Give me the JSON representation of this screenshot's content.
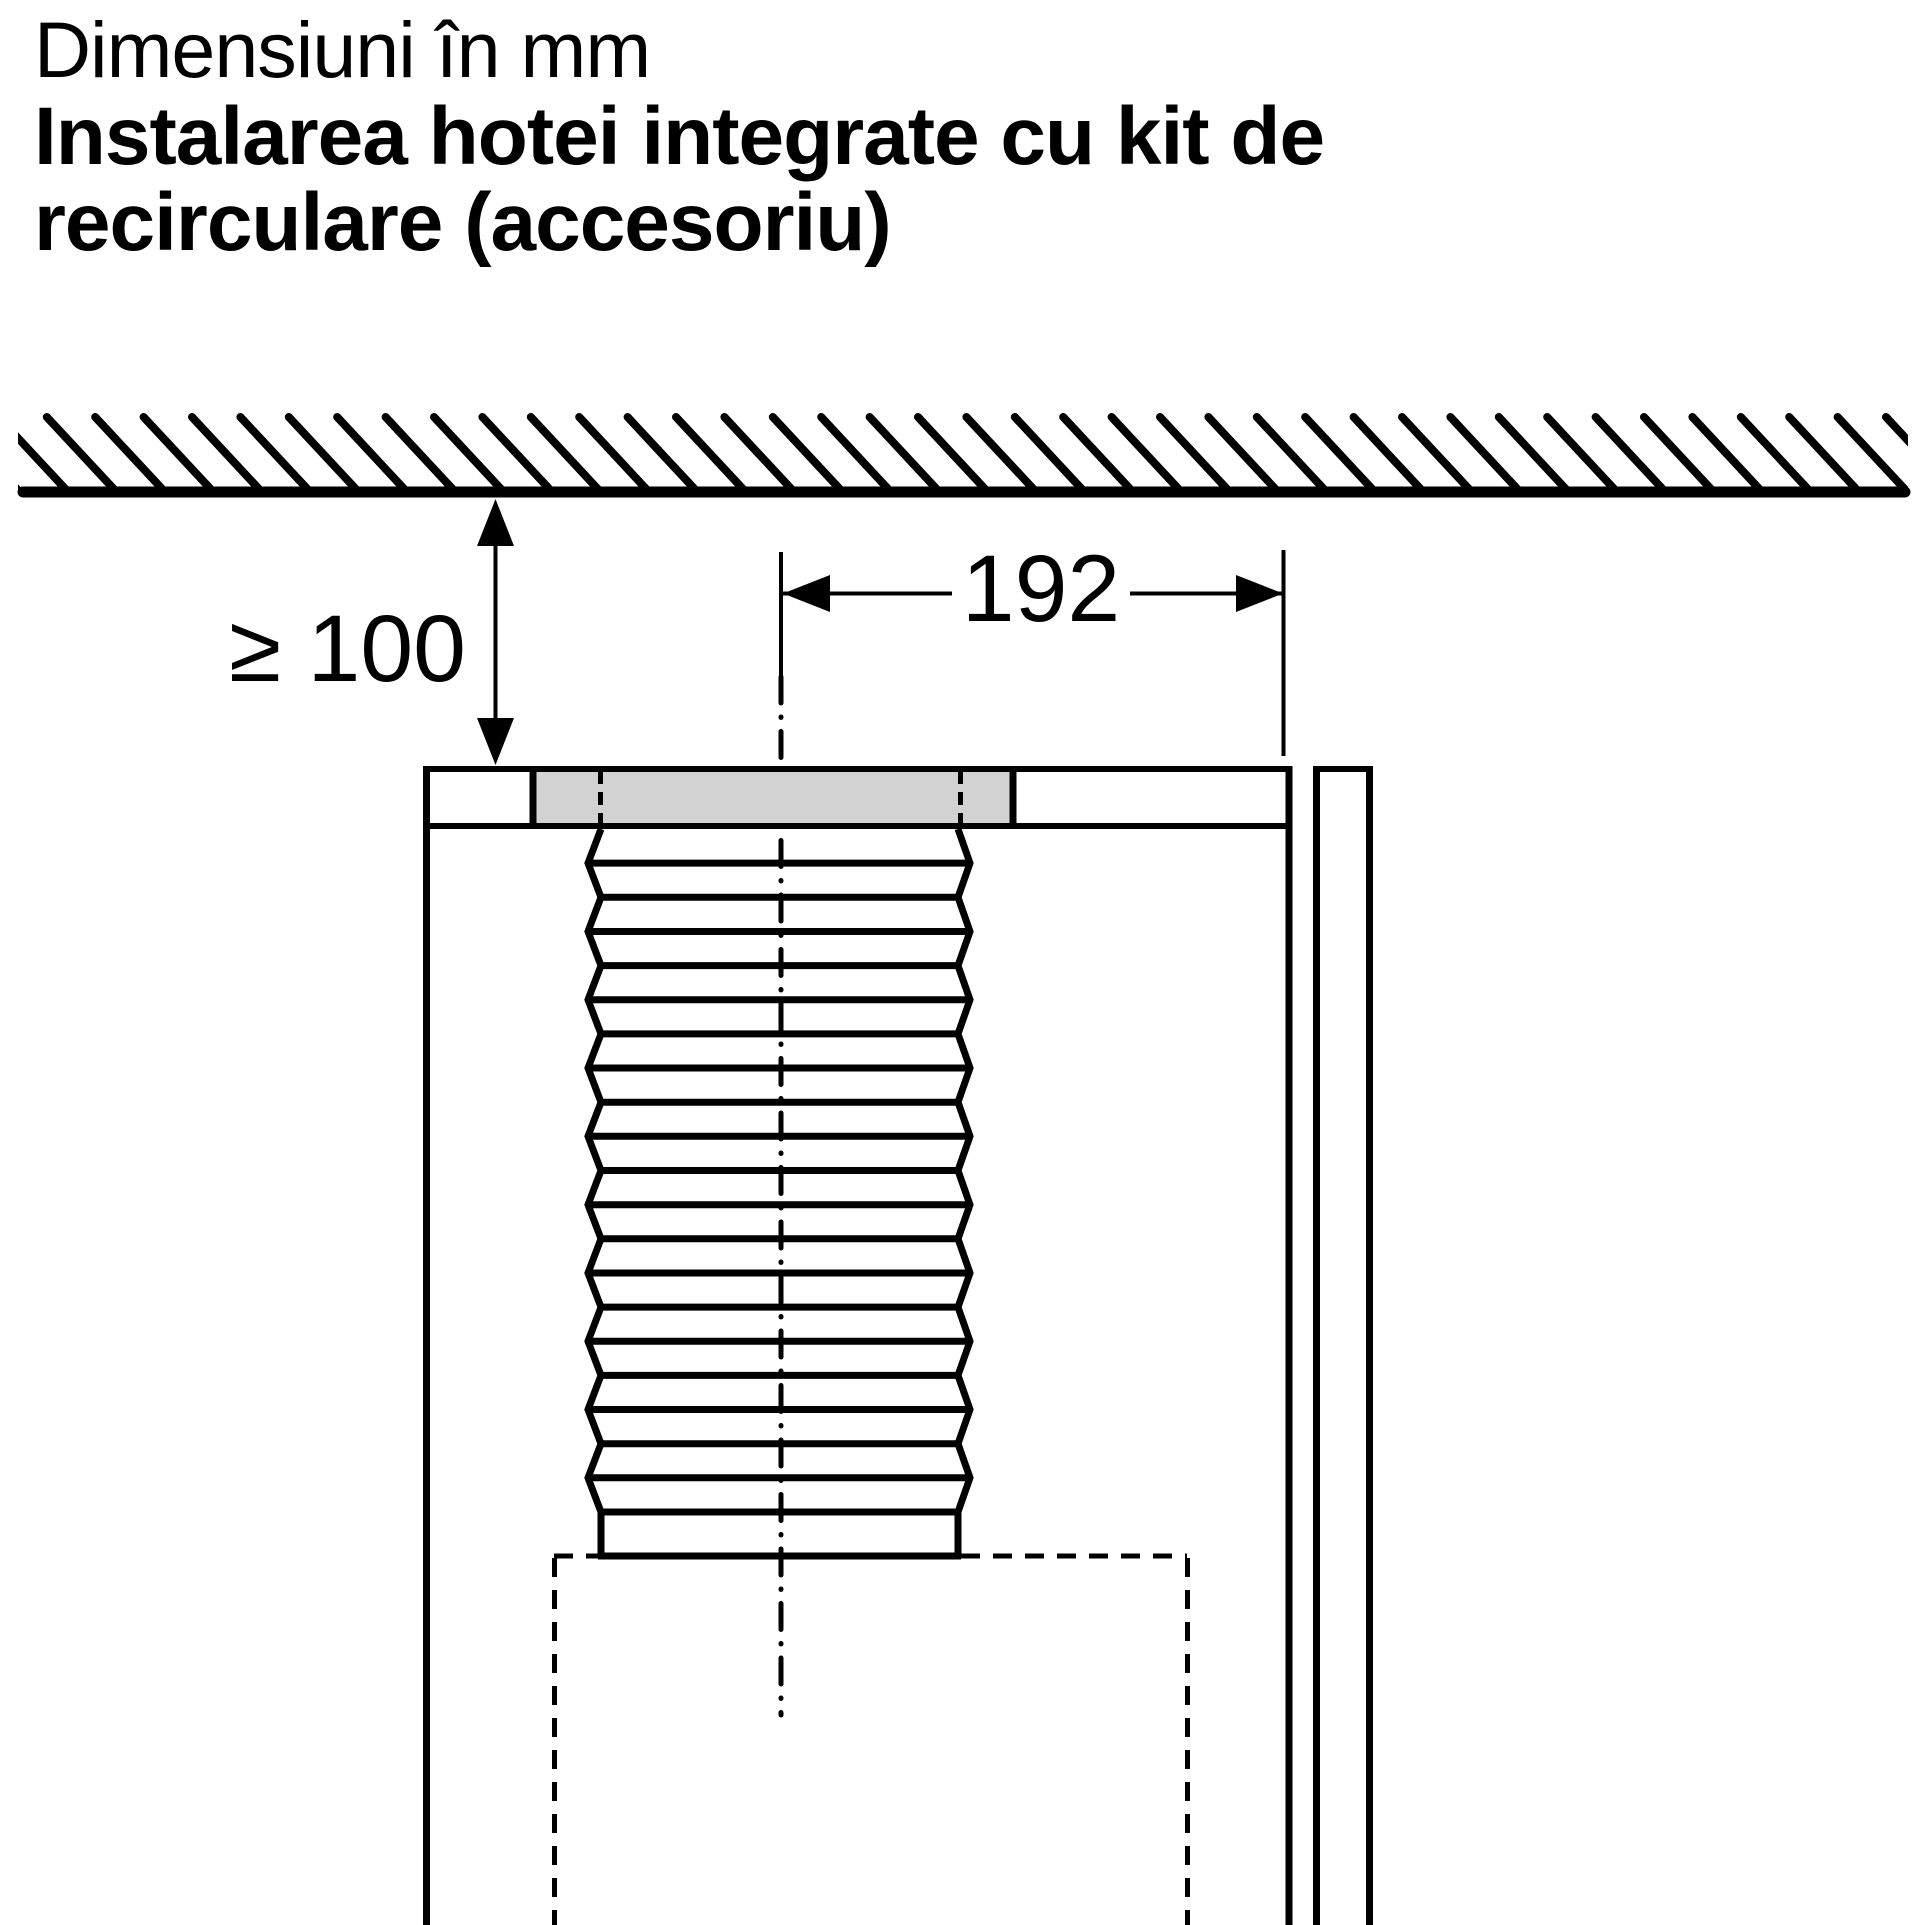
{
  "title": {
    "line1": "Dimensiuni în mm",
    "line2": "Instalarea hotei integrate cu kit de",
    "line3": "recirculare (accesoriu)"
  },
  "dimensions": {
    "clearance_label": "≥ 100",
    "width_label": "192"
  },
  "colors": {
    "line": "#000000",
    "kit_fill": "#d2d2d2",
    "background": "#ffffff"
  }
}
